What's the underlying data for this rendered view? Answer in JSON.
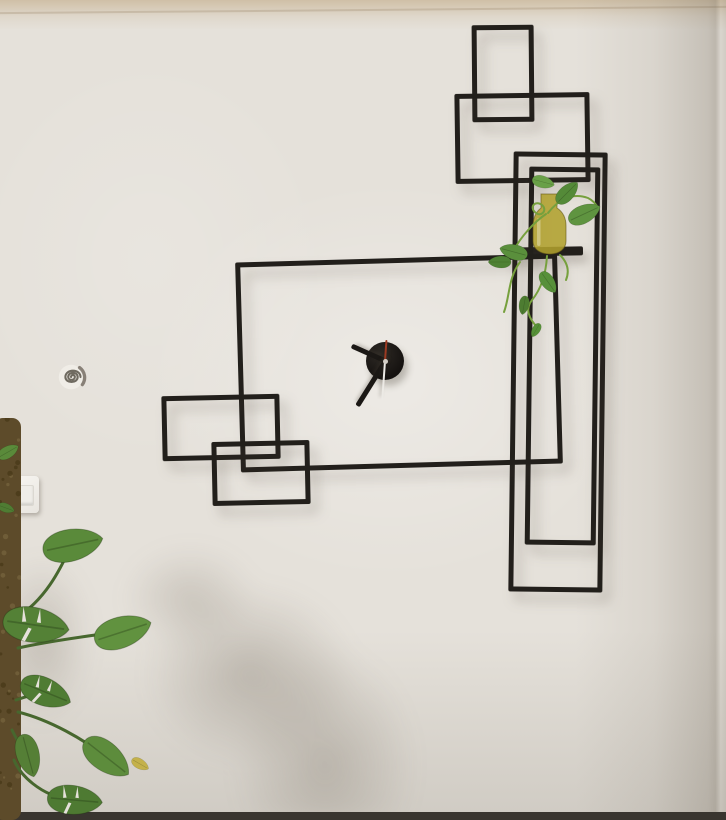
{
  "meta": {
    "scene_description": "Photograph of a minimalist black metal wall sculpture clock made of overlapping rectangles on an off-white plaster wall, with a small shelf holding a yellow glass vase with pothos cuttings, a monstera plant on a moss pole at lower left, a white light switch and a small spiral wall anchor",
    "image_width": 726,
    "image_height": 820
  },
  "scene": {
    "colors": {
      "wall_base": "#e5e1da",
      "frame": "#221f1b",
      "floor": "#39352f",
      "stem": "#47672e",
      "vine": "#76a03d",
      "pole": "#5d4b2a",
      "wall_patch": "#f0ede7",
      "spiral": "#6f6a60"
    },
    "wall_art": {
      "bar_thickness": 5,
      "rectangles": [
        {
          "name": "top-portrait",
          "x": 472,
          "y": 25,
          "w": 62,
          "h": 97,
          "rot": -0.5
        },
        {
          "name": "upper-wide",
          "x": 455,
          "y": 93,
          "w": 135,
          "h": 90,
          "rot": -0.8
        },
        {
          "name": "tall-outer",
          "x": 511,
          "y": 152,
          "w": 94,
          "h": 440,
          "rot": 0.7
        },
        {
          "name": "tall-inner",
          "x": 527,
          "y": 167,
          "w": 71,
          "h": 378,
          "rot": 0.7
        },
        {
          "name": "central-large",
          "x": 238,
          "y": 258,
          "w": 322,
          "h": 210,
          "rot": -1.6
        },
        {
          "name": "left-upper-small",
          "x": 162,
          "y": 395,
          "w": 118,
          "h": 65,
          "rot": -1.2
        },
        {
          "name": "left-lower-small",
          "x": 212,
          "y": 441,
          "w": 98,
          "h": 64,
          "rot": -1.2
        }
      ],
      "shelf": {
        "x": 505,
        "y": 247,
        "w": 78,
        "h": 9,
        "rot": -1
      }
    },
    "clock": {
      "cx": 385,
      "cy": 361,
      "disc": {
        "d": 38
      },
      "hand_color": "#1b1815",
      "hour": {
        "angle": -66,
        "length": 37,
        "width": 5
      },
      "minute": {
        "angle": -148,
        "length": 53,
        "width": 5
      },
      "second": {
        "angle": 4,
        "length": 21,
        "width": 2,
        "color": "#9c3a22"
      },
      "second_tail": {
        "angle": 184,
        "length": 39,
        "width": 2,
        "color": "#eceae5"
      },
      "pin_color": "#d3cec6"
    },
    "light_switch": {
      "x": 9,
      "y": 476,
      "w": 30,
      "h": 37
    },
    "wall_anchor": {
      "cx": 72,
      "cy": 378,
      "size": 34
    },
    "plants": {
      "monstera": {
        "pole": {
          "x": -6,
          "y": 418,
          "w": 27,
          "h": 402
        },
        "leaves": [
          {
            "x": 72,
            "y": 545,
            "w": 64,
            "rot": -12,
            "color": "#5a8a3a",
            "fen": false
          },
          {
            "x": 35,
            "y": 625,
            "w": 70,
            "rot": 8,
            "color": "#548136",
            "fen": true
          },
          {
            "x": 122,
            "y": 632,
            "w": 62,
            "rot": -18,
            "color": "#61923f",
            "fen": false
          },
          {
            "x": 45,
            "y": 692,
            "w": 56,
            "rot": 22,
            "color": "#4f7c33",
            "fen": true
          },
          {
            "x": 28,
            "y": 755,
            "w": 46,
            "rot": 75,
            "color": "#557f36",
            "fen": false
          },
          {
            "x": 106,
            "y": 757,
            "w": 58,
            "rot": 38,
            "color": "#5d8c3c",
            "fen": false
          },
          {
            "x": 74,
            "y": 800,
            "w": 58,
            "rot": 5,
            "color": "#4e7a32",
            "fen": true
          },
          {
            "x": 140,
            "y": 764,
            "w": 20,
            "rot": 30,
            "color": "#c4b14a",
            "fen": false
          },
          {
            "x": 8,
            "y": 452,
            "w": 24,
            "rot": -30,
            "color": "#5a8a3a",
            "fen": false
          },
          {
            "x": 6,
            "y": 508,
            "w": 18,
            "rot": 20,
            "color": "#4f7c33",
            "fen": false
          }
        ]
      },
      "shelf_plant": {
        "vase": {
          "color": "#b1a02e"
        },
        "leaves": [
          {
            "x": 584,
            "y": 214,
            "w": 36,
            "rot": -25,
            "color": "#5f9440",
            "fen": false
          },
          {
            "x": 567,
            "y": 193,
            "w": 30,
            "rot": -45,
            "color": "#548a38",
            "fen": false
          },
          {
            "x": 543,
            "y": 182,
            "w": 24,
            "rot": 15,
            "color": "#69a047",
            "fen": false
          },
          {
            "x": 514,
            "y": 252,
            "w": 30,
            "rot": 195,
            "color": "#5a8f3c",
            "fen": false
          },
          {
            "x": 500,
            "y": 262,
            "w": 24,
            "rot": 180,
            "color": "#4f8234",
            "fen": false
          },
          {
            "x": 548,
            "y": 282,
            "w": 26,
            "rot": 55,
            "color": "#57903a",
            "fen": false
          },
          {
            "x": 524,
            "y": 305,
            "w": 20,
            "rot": 100,
            "color": "#4d7c31",
            "fen": false
          },
          {
            "x": 536,
            "y": 330,
            "w": 16,
            "rot": 120,
            "color": "#569038",
            "fen": false
          }
        ]
      }
    }
  }
}
